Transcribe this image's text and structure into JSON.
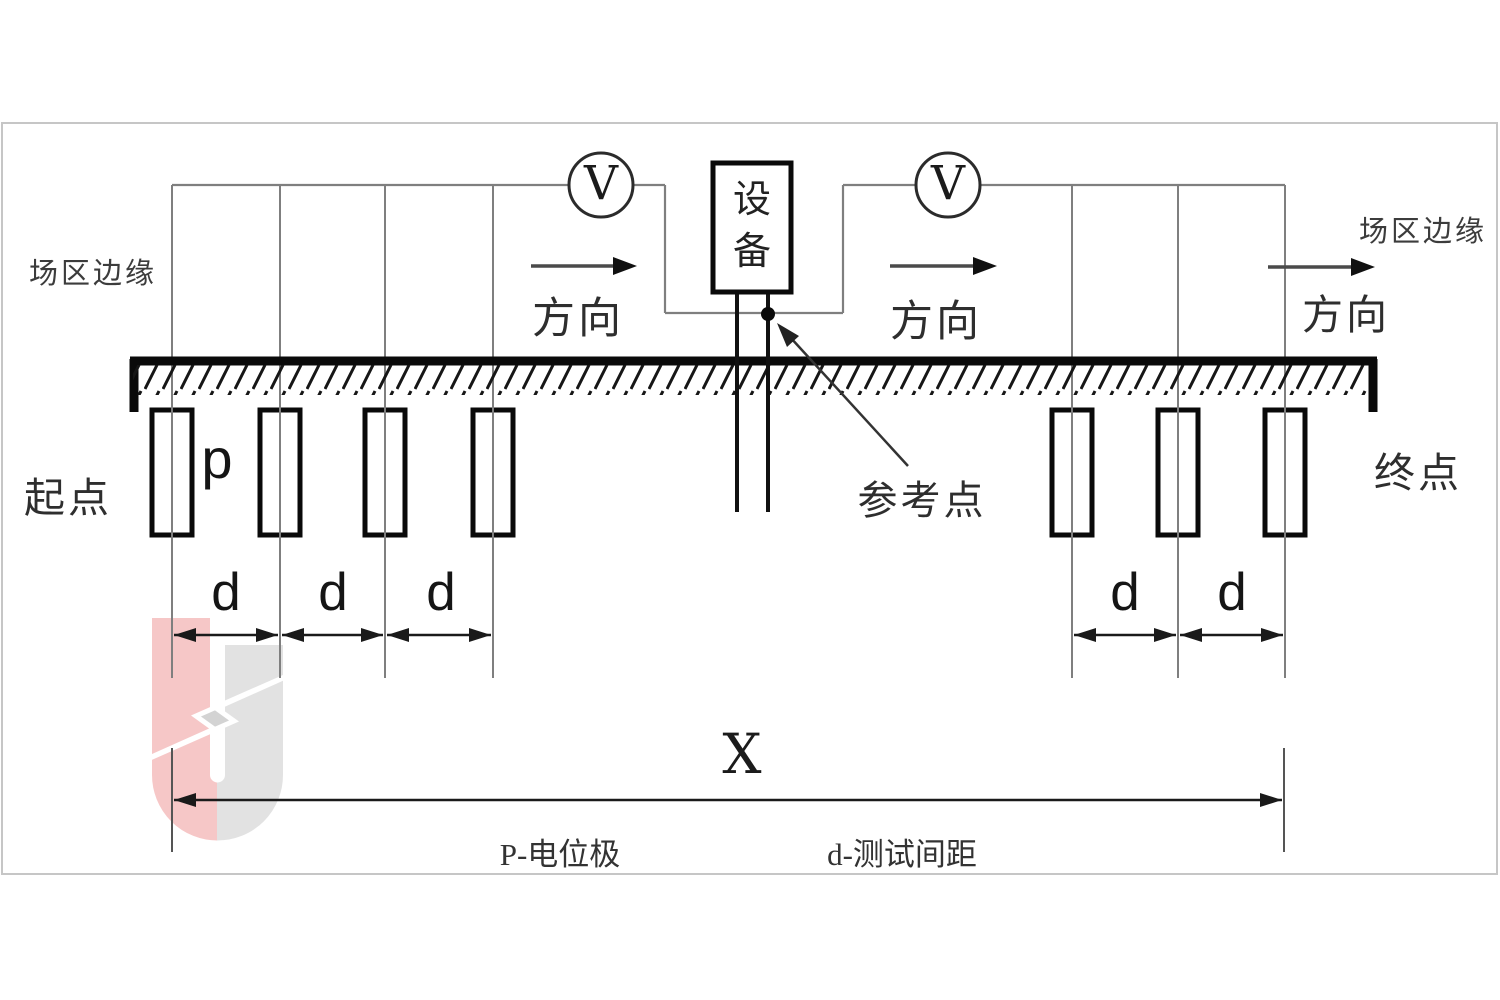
{
  "diagram_title": "ground-grid potential electrode test layout",
  "labels": {
    "field_edge": "场区边缘",
    "direction": "方向",
    "start_point": "起点",
    "end_point": "终点",
    "reference_point": "参考点",
    "equipment": "设备",
    "voltmeter": "V",
    "potential_electrode": "p",
    "spacing": "d",
    "total_distance": "X"
  },
  "legend": {
    "p_definition": "P-电位极",
    "d_definition": "d-测试间距"
  },
  "counts": {
    "left_electrodes": 4,
    "right_electrodes": 3,
    "voltmeters": 2,
    "spacing_marks_left": 3,
    "spacing_marks_right": 2
  },
  "colors": {
    "line_black": "#0a0a0a",
    "wire_gray": "#7f7f7f",
    "frame_gray": "#c6c6c6",
    "text_gray": "#3c3c3c",
    "logo_pink": "#f5baba",
    "logo_gray": "#dcdcdc",
    "background": "#ffffff"
  }
}
